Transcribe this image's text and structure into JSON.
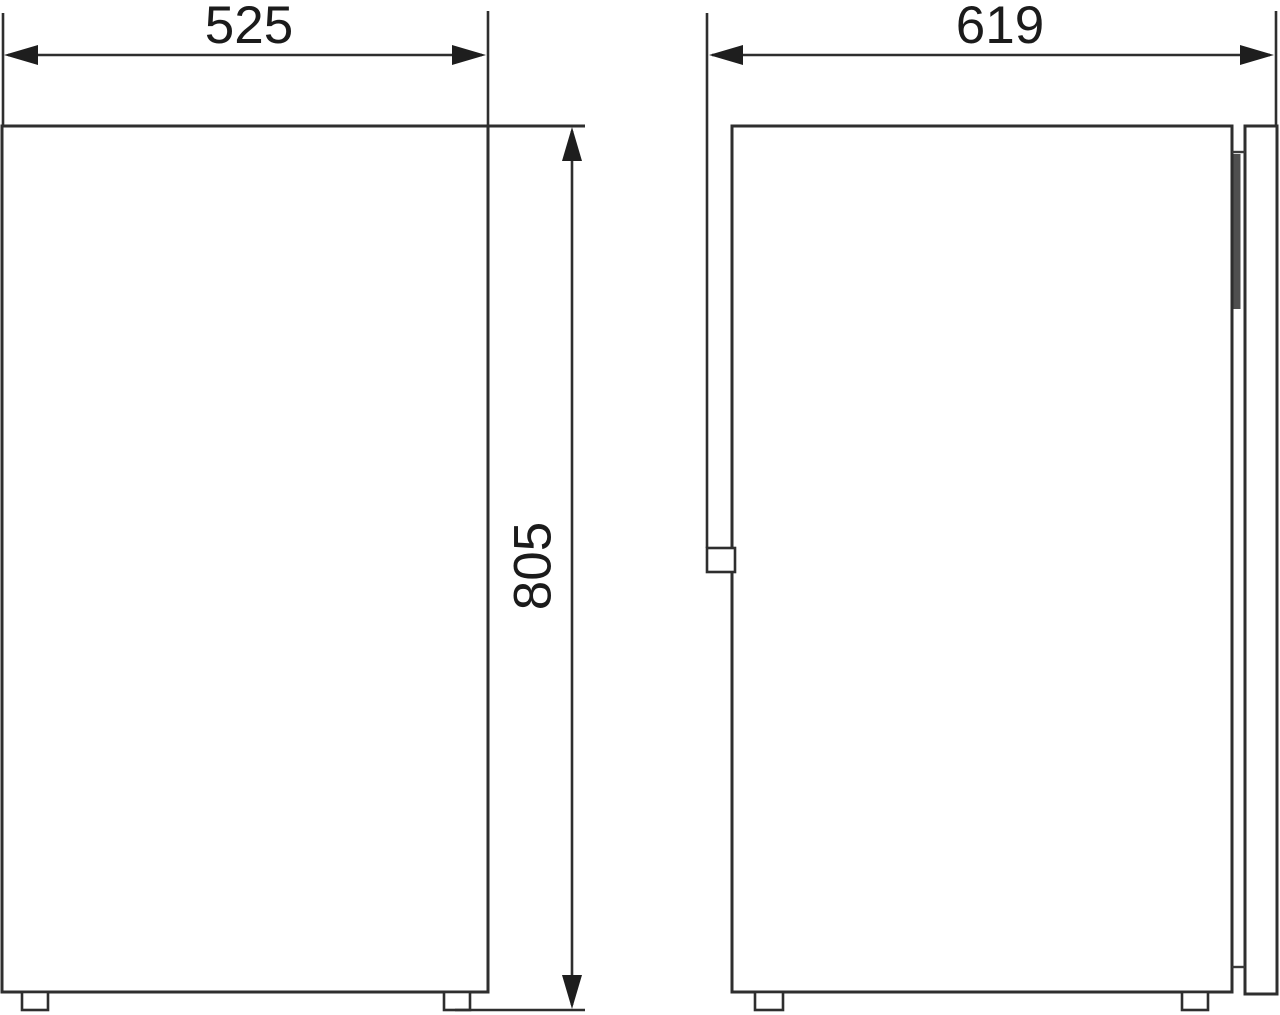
{
  "dimensions": {
    "front_width_label": "525",
    "side_depth_label": "619",
    "front_height_label": "805"
  },
  "colors": {
    "line": "#2e2e2e",
    "arrow": "#1e1e1e",
    "hinge_bar": "#4f4f4f",
    "background": "#ffffff"
  }
}
